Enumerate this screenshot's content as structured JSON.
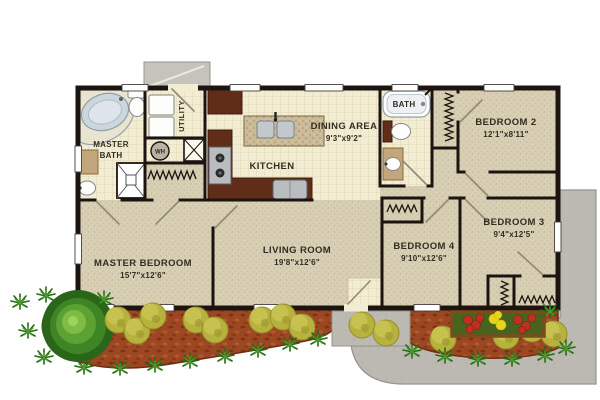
{
  "plan": {
    "rooms": {
      "master_bath": {
        "line1": "MASTER",
        "line2": "BATH"
      },
      "utility": {
        "name": "UTILITY"
      },
      "kitchen": {
        "name": "KITCHEN"
      },
      "dining": {
        "name": "DINING AREA",
        "dims": "9'3\"x9'2\""
      },
      "hall_bath": {
        "name": "BATH"
      },
      "bedroom2": {
        "name": "BEDROOM 2",
        "dims": "12'1\"x8'11\""
      },
      "bedroom3": {
        "name": "BEDROOM 3",
        "dims": "9'4\"x12'5\""
      },
      "bedroom4": {
        "name": "BEDROOM 4",
        "dims": "9'10\"x12'6\""
      },
      "living_room": {
        "name": "LIVING ROOM",
        "dims": "19'8\"x12'6\""
      },
      "master_bedroom": {
        "name": "MASTER BEDROOM",
        "dims": "15'7\"x12'6\""
      }
    },
    "fixtures": {
      "water_heater_label": "WH"
    },
    "colors": {
      "wall": "#1c1410",
      "carpet": "#d7ceb3",
      "tile": "#f2ecd3",
      "wood_cabinet": "#5f2d18",
      "island_top": "#cbbb98",
      "concrete": "#bcb9b3",
      "stoop": "#c6c3bd",
      "mulch": "#9c4722",
      "bush_yellow": "#b7b13e",
      "plant_green": "#2f7a1e",
      "flower_red": "#c03020",
      "flower_yellow": "#e8d41c",
      "tub_blue": "#ccd6dd"
    }
  }
}
